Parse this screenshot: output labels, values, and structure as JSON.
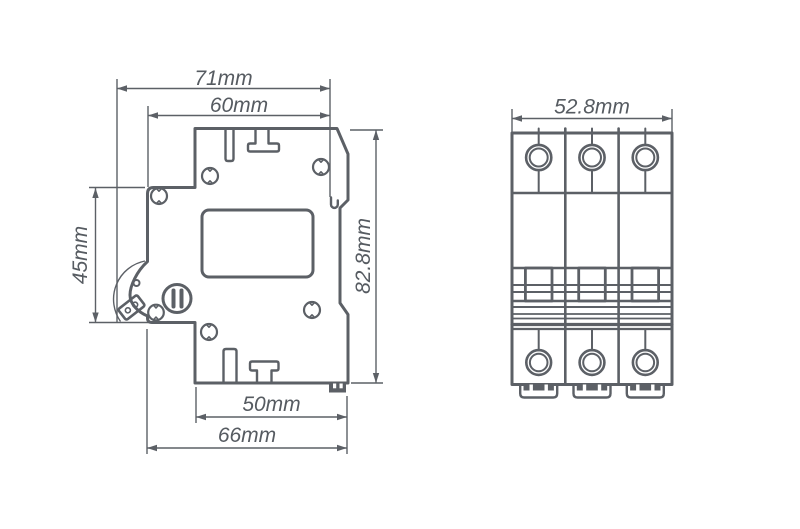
{
  "diagram": {
    "subject": "Miniature circuit breaker (MCB) technical dimension drawing",
    "colors": {
      "line": "#5c6066",
      "text": "#565b61",
      "background": "#ffffff"
    },
    "views": {
      "side": {
        "label": "side-profile-view",
        "dims": {
          "overall_depth": "71mm",
          "upper_depth": "60mm",
          "front_face_height": "45mm",
          "overall_height": "82.8mm",
          "base_depth_inner": "50mm",
          "base_depth_overall": "66mm"
        }
      },
      "front": {
        "label": "front-view",
        "poles": 3,
        "dims": {
          "overall_width": "52.8mm"
        }
      }
    }
  }
}
